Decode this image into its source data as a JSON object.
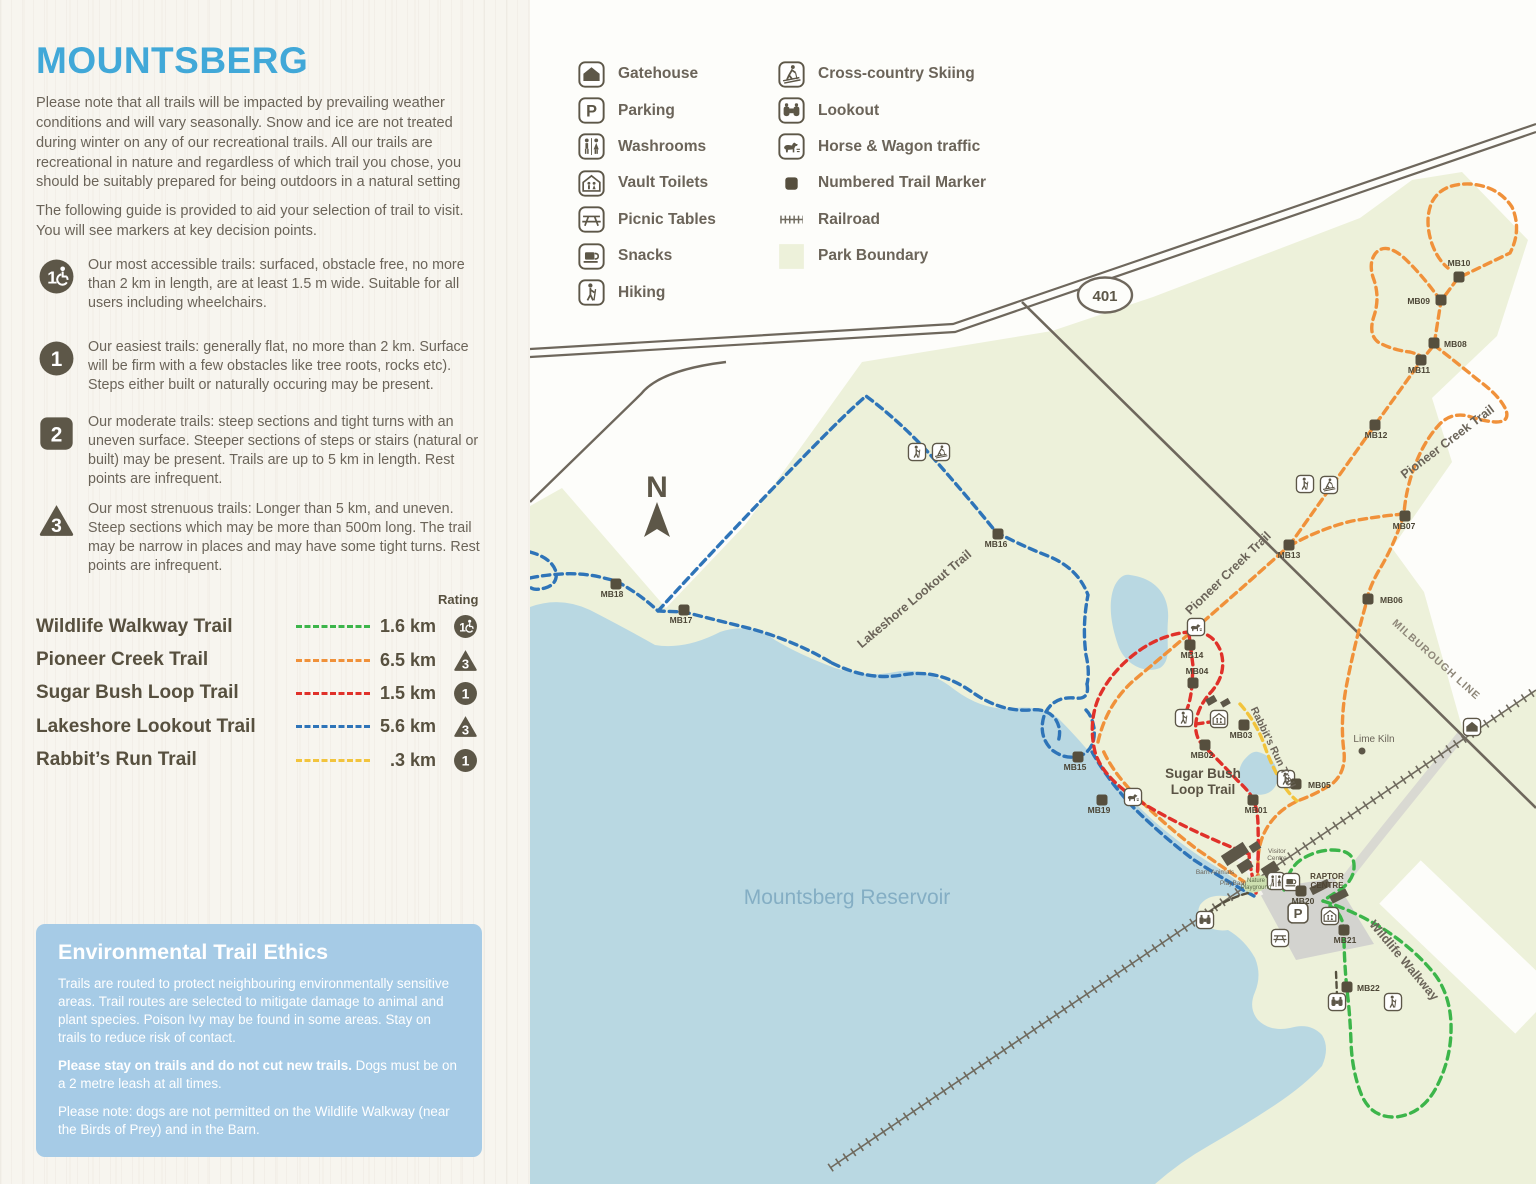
{
  "panel": {
    "title": "MOUNTSBERG",
    "intro1": "Please note that all trails will be impacted by prevailing weather conditions and will vary seasonally. Snow and ice are not treated during winter on any of our recreational trails. All our trails are recreational in nature and regardless of which trail you chose, you should be suitably prepared for being outdoors in a natural setting",
    "intro2": "The following guide is provided to aid your selection of trail to visit. You will see markers at key decision points.",
    "rating_header": "Rating",
    "difficulty": [
      {
        "icon": "access",
        "top": 256,
        "text": "Our most accessible trails: surfaced, obstacle free, no more than 2 km in length, are at least 1.5 m wide. Suitable for all users including wheelchairs."
      },
      {
        "icon": "1",
        "top": 338,
        "text": "Our easiest trails: generally flat, no more than 2 km. Surface will be firm with a few obstacles like tree roots, rocks etc). Steps either built or naturally occuring may be present."
      },
      {
        "icon": "2",
        "top": 413,
        "text": "Our moderate trails: steep sections and tight turns with an uneven surface. Steeper sections of steps or stairs (natural or built) may be present. Trails are up to 5 km in length. Rest points are infrequent."
      },
      {
        "icon": "3",
        "top": 500,
        "text": "Our most strenuous trails: Longer than 5 km, and uneven. Steep sections which may be more than 500m long. The trail may be narrow in places and may have some tight turns. Rest points are infrequent."
      }
    ],
    "trails": [
      {
        "name": "Wildlife Walkway Trail",
        "color": "#3cb54a",
        "distance": "1.6 km",
        "rating": "access"
      },
      {
        "name": "Pioneer Creek Trail",
        "color": "#f0913a",
        "distance": "6.5 km",
        "rating": "3"
      },
      {
        "name": "Sugar Bush Loop Trail",
        "color": "#e0312a",
        "distance": "1.5 km",
        "rating": "1"
      },
      {
        "name": "Lakeshore Lookout Trail",
        "color": "#2e74b8",
        "distance": "5.6 km",
        "rating": "3"
      },
      {
        "name": "Rabbit’s Run Trail",
        "color": "#f2c43d",
        "distance": ".3 km",
        "rating": "1"
      }
    ],
    "ethics": {
      "title": "Environmental Trail Ethics",
      "p1": "Trails are routed to protect neighbouring environmentally sensitive areas. Trail routes are selected to mitigate damage to animal and plant species. Poison Ivy may be found in some areas. Stay on trails to reduce risk of contact.",
      "p2_bold": "Please stay on trails and do not cut new trails.",
      "p2_rest": " Dogs must be on a 2 metre leash at all times.",
      "p3": "Please note: dogs are not permitted on the Wildlife Walkway (near the Birds of Prey) and in the Barn."
    }
  },
  "legend": {
    "col1": [
      {
        "icon": "gatehouse",
        "label": "Gatehouse"
      },
      {
        "icon": "parking",
        "label": "Parking"
      },
      {
        "icon": "washrooms",
        "label": "Washrooms"
      },
      {
        "icon": "vault-toilets",
        "label": "Vault Toilets"
      },
      {
        "icon": "picnic",
        "label": "Picnic Tables"
      },
      {
        "icon": "snacks",
        "label": "Snacks"
      },
      {
        "icon": "hiking",
        "label": "Hiking"
      }
    ],
    "col2": [
      {
        "icon": "ski",
        "label": "Cross-country Skiing"
      },
      {
        "icon": "lookout",
        "label": "Lookout"
      },
      {
        "icon": "horse",
        "label": "Horse & Wagon traffic"
      },
      {
        "icon": "marker",
        "label": "Numbered Trail Marker"
      },
      {
        "icon": "railroad",
        "label": "Railroad"
      },
      {
        "icon": "boundary",
        "label": "Park Boundary"
      }
    ]
  },
  "map": {
    "highway_badge": "401",
    "markers": [
      {
        "id": "MB01",
        "x": 1253,
        "y": 800,
        "lx": 1256,
        "ly": 813,
        "a": "middle"
      },
      {
        "id": "MB02",
        "x": 1205,
        "y": 745,
        "lx": 1202,
        "ly": 758,
        "a": "middle"
      },
      {
        "id": "MB03",
        "x": 1244,
        "y": 725,
        "lx": 1241,
        "ly": 738,
        "a": "middle"
      },
      {
        "id": "MB04",
        "x": 1193,
        "y": 683,
        "lx": 1197,
        "ly": 674,
        "a": "middle"
      },
      {
        "id": "MB05",
        "x": 1296,
        "y": 784,
        "lx": 1308,
        "ly": 788,
        "a": "start"
      },
      {
        "id": "MB06",
        "x": 1368,
        "y": 599,
        "lx": 1380,
        "ly": 603,
        "a": "start"
      },
      {
        "id": "MB07",
        "x": 1405,
        "y": 516,
        "lx": 1404,
        "ly": 529,
        "a": "middle"
      },
      {
        "id": "MB08",
        "x": 1434,
        "y": 343,
        "lx": 1444,
        "ly": 347,
        "a": "start"
      },
      {
        "id": "MB09",
        "x": 1441,
        "y": 300,
        "lx": 1430,
        "ly": 304,
        "a": "end"
      },
      {
        "id": "MB10",
        "x": 1459,
        "y": 277,
        "lx": 1459,
        "ly": 266,
        "a": "middle"
      },
      {
        "id": "MB11",
        "x": 1421,
        "y": 360,
        "lx": 1419,
        "ly": 373,
        "a": "middle"
      },
      {
        "id": "MB12",
        "x": 1375,
        "y": 425,
        "lx": 1376,
        "ly": 438,
        "a": "middle"
      },
      {
        "id": "MB13",
        "x": 1289,
        "y": 545,
        "lx": 1289,
        "ly": 558,
        "a": "middle"
      },
      {
        "id": "MB14",
        "x": 1190,
        "y": 645,
        "lx": 1192,
        "ly": 658,
        "a": "middle"
      },
      {
        "id": "MB15",
        "x": 1078,
        "y": 757,
        "lx": 1075,
        "ly": 770,
        "a": "middle"
      },
      {
        "id": "MB16",
        "x": 998,
        "y": 534,
        "lx": 996,
        "ly": 547,
        "a": "middle"
      },
      {
        "id": "MB17",
        "x": 684,
        "y": 610,
        "lx": 681,
        "ly": 623,
        "a": "middle"
      },
      {
        "id": "MB18",
        "x": 616,
        "y": 584,
        "lx": 612,
        "ly": 597,
        "a": "middle"
      },
      {
        "id": "MB19",
        "x": 1102,
        "y": 800,
        "lx": 1099,
        "ly": 813,
        "a": "middle"
      },
      {
        "id": "MB20",
        "x": 1301,
        "y": 891,
        "lx": 1303,
        "ly": 904,
        "a": "middle"
      },
      {
        "id": "MB21",
        "x": 1344,
        "y": 930,
        "lx": 1345,
        "ly": 943,
        "a": "middle"
      },
      {
        "id": "MB22",
        "x": 1347,
        "y": 987,
        "lx": 1357,
        "ly": 991,
        "a": "start"
      }
    ],
    "icons": [
      {
        "t": "hiking",
        "x": 917,
        "y": 452
      },
      {
        "t": "ski",
        "x": 941,
        "y": 452
      },
      {
        "t": "hiking",
        "x": 1305,
        "y": 484
      },
      {
        "t": "ski",
        "x": 1329,
        "y": 485
      },
      {
        "t": "horse",
        "x": 1196,
        "y": 627
      },
      {
        "t": "horse",
        "x": 1133,
        "y": 797
      },
      {
        "t": "hiking",
        "x": 1184,
        "y": 718
      },
      {
        "t": "vault-toilets",
        "x": 1219,
        "y": 719
      },
      {
        "t": "hiking",
        "x": 1286,
        "y": 779
      },
      {
        "t": "washrooms",
        "x": 1276,
        "y": 881
      },
      {
        "t": "snacks",
        "x": 1291,
        "y": 882
      },
      {
        "t": "parking",
        "x": 1298,
        "y": 913,
        "s": 22
      },
      {
        "t": "vault-toilets",
        "x": 1330,
        "y": 916
      },
      {
        "t": "picnic",
        "x": 1280,
        "y": 938
      },
      {
        "t": "lookout",
        "x": 1205,
        "y": 920
      },
      {
        "t": "lookout",
        "x": 1337,
        "y": 1002
      },
      {
        "t": "hiking",
        "x": 1393,
        "y": 1002
      },
      {
        "t": "gatehouse",
        "x": 1472,
        "y": 727
      }
    ],
    "labels": [
      {
        "text": "Pioneer Creek Trail",
        "x": 1231,
        "y": 576,
        "r": -44,
        "s": 12.5,
        "c": "#6b6459",
        "w": 600
      },
      {
        "text": "Pioneer Creek Trail",
        "x": 1450,
        "y": 445,
        "r": -37,
        "s": 12.5,
        "c": "#6b6459",
        "w": 600
      },
      {
        "text": "Lakeshore Lookout Trail",
        "x": 917,
        "y": 602,
        "r": -40,
        "s": 12.5,
        "c": "#6b6459",
        "w": 600
      },
      {
        "text": "Rabbit’s Run Trail",
        "x": 1270,
        "y": 749,
        "r": 64,
        "s": 10.5,
        "c": "#6b6459",
        "w": 600
      },
      {
        "text": "Wildlife Walkway",
        "x": 1401,
        "y": 963,
        "r": 50,
        "s": 12.5,
        "c": "#6b6459",
        "w": 600
      },
      {
        "text": "MILBUROUGH LINE",
        "x": 1434,
        "y": 662,
        "r": 42,
        "s": 10.5,
        "c": "#8d8678",
        "w": 700,
        "sp": 1
      },
      {
        "text": "Sugar Bush",
        "x": 1203,
        "y": 778,
        "s": 13.5,
        "c": "#5a5344",
        "w": 600
      },
      {
        "text": "Loop Trail",
        "x": 1203,
        "y": 794,
        "s": 13.5,
        "c": "#5a5344",
        "w": 600
      },
      {
        "text": "Lime Kiln",
        "x": 1374,
        "y": 742,
        "s": 10,
        "c": "#6b6459",
        "w": 500
      },
      {
        "text": "Mountsberg Reservoir",
        "x": 847,
        "y": 904,
        "s": 21,
        "c": "#84aec4",
        "w": 500
      },
      {
        "text": "RAPTOR",
        "x": 1327,
        "y": 879,
        "s": 8,
        "c": "#4f4433",
        "w": 700
      },
      {
        "text": "CENTRE",
        "x": 1327,
        "y": 888,
        "s": 8,
        "c": "#4f4433",
        "w": 700
      },
      {
        "text": "Visitor",
        "x": 1277,
        "y": 853,
        "s": 6.5,
        "c": "#6b6459",
        "w": 500
      },
      {
        "text": "Centre",
        "x": 1277,
        "y": 860,
        "s": 6.5,
        "c": "#6b6459",
        "w": 500
      },
      {
        "text": "Barn Animals",
        "x": 1215,
        "y": 874,
        "s": 6.5,
        "c": "#6b6459",
        "w": 500
      },
      {
        "text": "PlayBarn",
        "x": 1233,
        "y": 885,
        "s": 6.5,
        "c": "#6b6459",
        "w": 500
      },
      {
        "text": "Nature",
        "x": 1256,
        "y": 882,
        "s": 6,
        "c": "#5d6b4a",
        "w": 500
      },
      {
        "text": "Playground",
        "x": 1256,
        "y": 889,
        "s": 6,
        "c": "#5d6b4a",
        "w": 500
      },
      {
        "text": "N",
        "x": 657,
        "y": 497,
        "s": 30,
        "c": "#5d5748",
        "w": 700
      },
      {
        "text": "401",
        "x": 1105,
        "y": 301,
        "s": 15,
        "c": "#5d5748",
        "w": 700
      }
    ]
  },
  "colors": {
    "title_blue": "#41a8d8",
    "text": "#6b6459",
    "dark_brown": "#5d5748",
    "park_green": "#edf1da",
    "water": "#b9d8e2",
    "road": "#6e675c",
    "trail_green": "#3cb54a",
    "trail_orange": "#f0913a",
    "trail_red": "#e0312a",
    "trail_blue": "#2e74b8",
    "trail_yellow": "#f2c43d",
    "ethics_bg": "#a6cbe6"
  }
}
